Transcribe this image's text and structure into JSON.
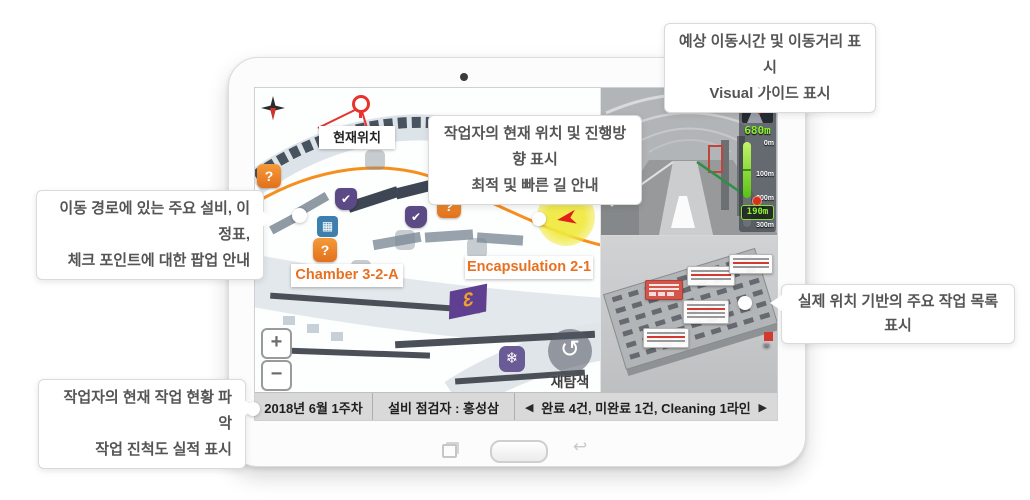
{
  "callouts": {
    "top_right": {
      "line1": "예상 이동시간 및 이동거리 표시",
      "line2": "Visual 가이드 표시"
    },
    "center": {
      "line1": "작업자의 현재 위치 및 진행방향 표시",
      "line2": "최적 및 빠른 길 안내"
    },
    "left": {
      "line1": "이동 경로에 있는 주요 설비, 이정표,",
      "line2": "체크 포인트에 대한 팝업 안내"
    },
    "right": {
      "line1": "실제 위치 기반의 주요 작업 목록 표시"
    },
    "bottom_left": {
      "line1": "작업자의 현재 작업 현황 파악",
      "line2": "작업 진척도 실적 표시"
    }
  },
  "map": {
    "current_location": "현재위치",
    "chamber_label": "Chamber 3-2-A",
    "encapsulation_label": "Encapsulation 2-1",
    "zone_number": "3",
    "zoom_in": "+",
    "zoom_out": "−",
    "research": "재탐색",
    "question_glyph": "?",
    "check_glyph": "✔",
    "equip_glyph": "▦",
    "snow_glyph": "❄",
    "refresh_glyph": "↺"
  },
  "nav": {
    "header": "다음안내",
    "distance_total": "680m",
    "tick_0": "0m",
    "tick_100": "100m",
    "tick_200": "200m",
    "tick_300": "300m",
    "distance_remaining": "190m"
  },
  "status_bar": {
    "date": "2018년 6월 1주차",
    "inspector": "설비 점검자 : 홍성삼",
    "prev": "◀",
    "summary": "완료 4건, 미완료 1건, Cleaning 1라인",
    "next": "▶"
  },
  "colors": {
    "accent_orange": "#E87722",
    "route_orange": "#F78F1E",
    "highlight_yellow": "#EEE83C",
    "marker_purple": "#5B4A86",
    "gauge_green": "#7CE32A",
    "alert_red": "#E8322E"
  }
}
